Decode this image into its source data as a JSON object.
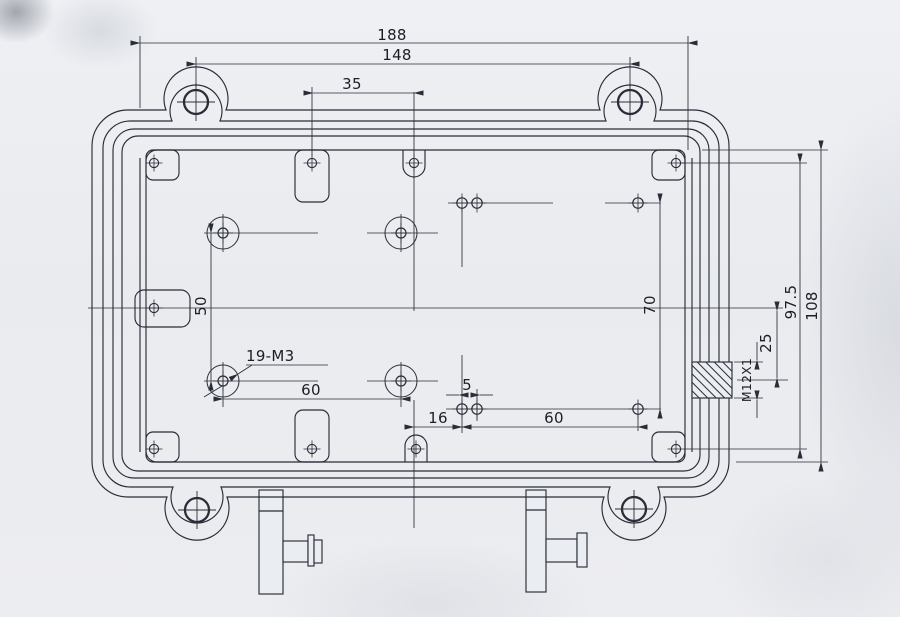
{
  "title": "Enclosure housing engineering drawing (top view)",
  "colors": {
    "paper": "#eaedf1",
    "ink": "#2a2d38",
    "centerline": "#45517c",
    "text": "#1c1e27"
  },
  "labels": {
    "width_overall": "188",
    "width_lugs": "148",
    "offset_pockets": "35",
    "boss_spacing_v": "50",
    "tap_callout": "19-M3",
    "boss_spacing_h": "60",
    "hole_offset_x": "16",
    "hole_pair_gap": "5",
    "hole_spacing_h": "60",
    "hole_spacing_v": "70",
    "gland_offset": "25",
    "gland_thread": "M12X1",
    "screw_spacing_v": "97.5",
    "body_height": "108"
  }
}
